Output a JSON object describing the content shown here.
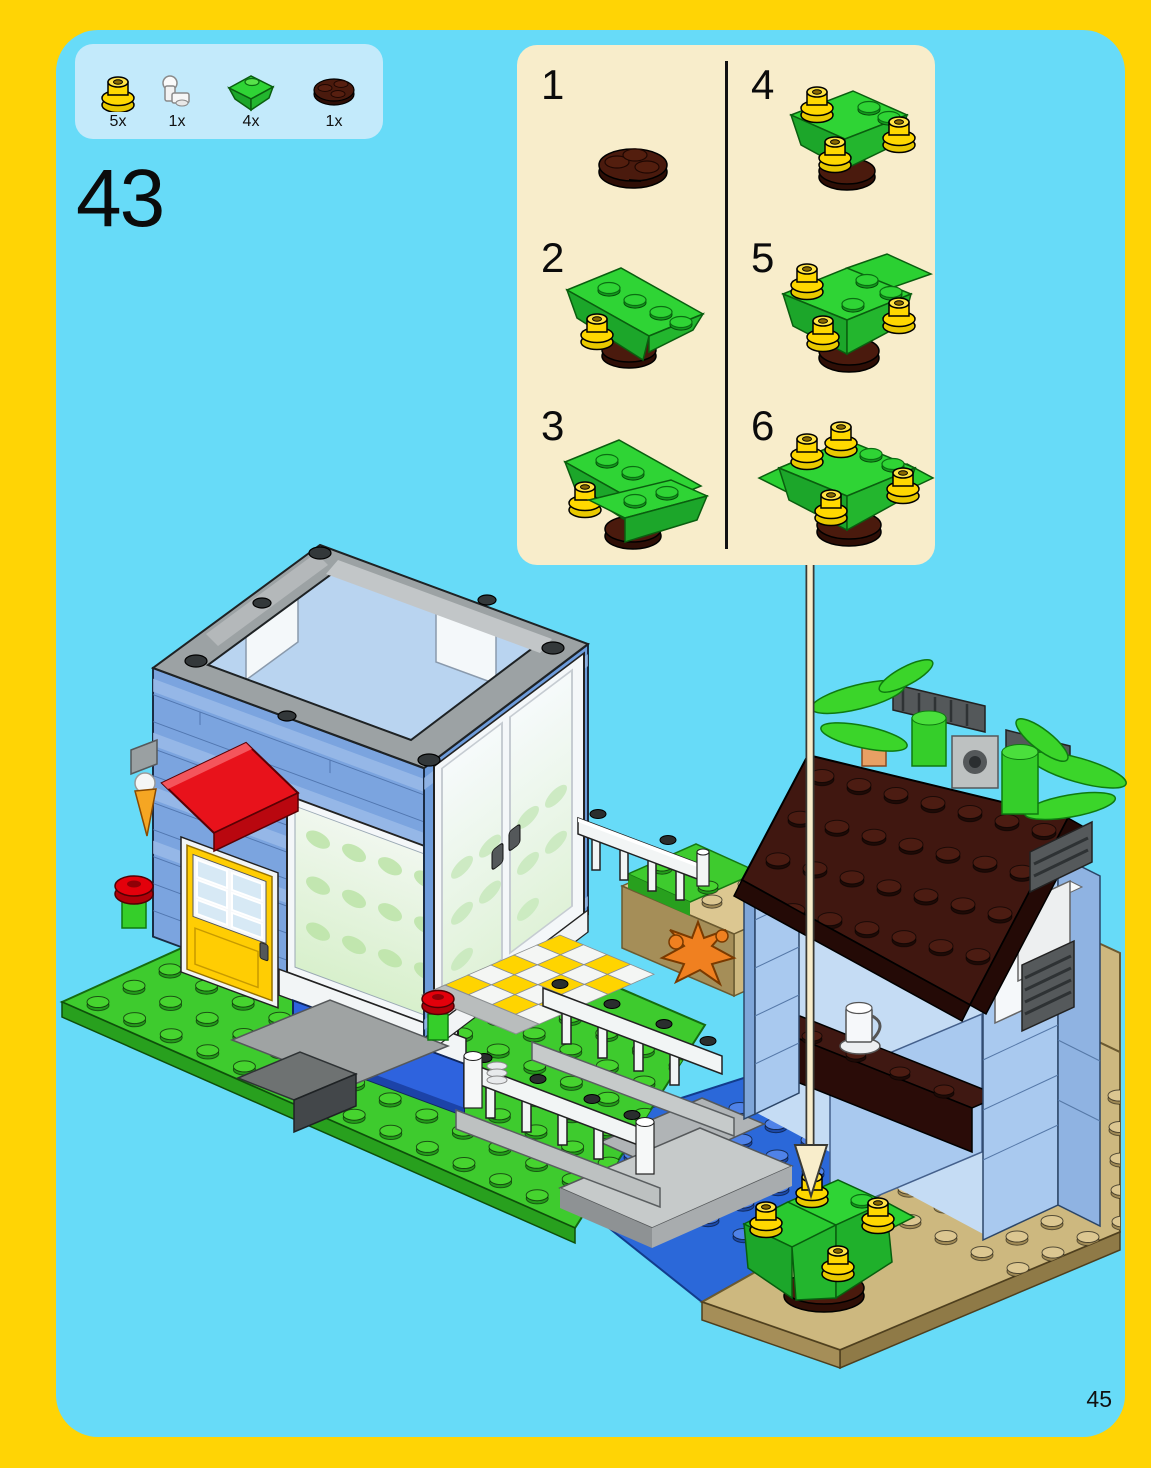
{
  "page": {
    "step_number": "43",
    "page_number": "45"
  },
  "parts_callout": {
    "items": [
      {
        "icon": "yellow-flower-stud-icon",
        "qty": "5x",
        "color": "#FFD800"
      },
      {
        "icon": "white-clip-arm-icon",
        "qty": "1x",
        "color": "#F4F6F6"
      },
      {
        "icon": "green-slope-brick-icon",
        "qty": "4x",
        "color": "#2FD435"
      },
      {
        "icon": "brown-round-plate-icon",
        "qty": "1x",
        "color": "#4A1A0D"
      }
    ]
  },
  "substeps": {
    "labels": [
      "1",
      "2",
      "3",
      "4",
      "5",
      "6"
    ]
  },
  "colors": {
    "frame_yellow": "#FFD405",
    "page_blue": "#67DBF8",
    "parts_box_blue": "#C3EAFB",
    "substep_panel_cream": "#F8EDCB",
    "baseplate_green": "#3ECB2E",
    "sand_tan": "#CDB87F",
    "water_blue": "#2B68D9",
    "building_blue": "#7BA4DF",
    "roof_trim_gray": "#9CA2A4",
    "awning_red": "#E3000B",
    "door_yellow": "#FFCD03",
    "hut_roof_brown": "#401710",
    "palm_green": "#3BD52A",
    "stud_yellow": "#FFD800",
    "window_box_blue": "#2E63DE"
  }
}
